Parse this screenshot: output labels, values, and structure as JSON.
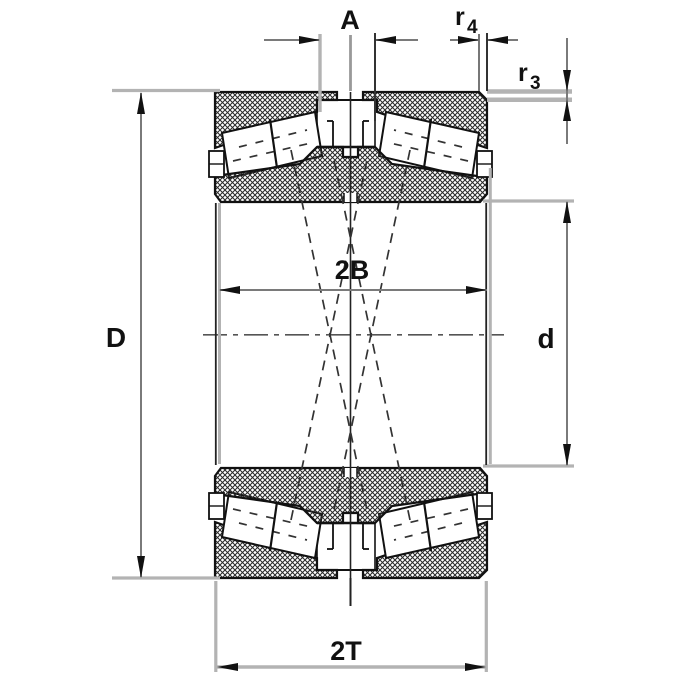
{
  "labels": {
    "axial_gap": "A",
    "chamfer_r4": {
      "base": "r",
      "sub": "4"
    },
    "chamfer_r3": {
      "base": "r",
      "sub": "3"
    },
    "outer_diameter": "D",
    "inner_rings_width": "2B",
    "bore_diameter": "d",
    "total_width": "2T"
  },
  "colors": {
    "line": "#111111",
    "dimension_line": "#7a7a7a",
    "extension_line": "#b3b3b3",
    "centerline": "#555555",
    "background": "#ffffff"
  }
}
